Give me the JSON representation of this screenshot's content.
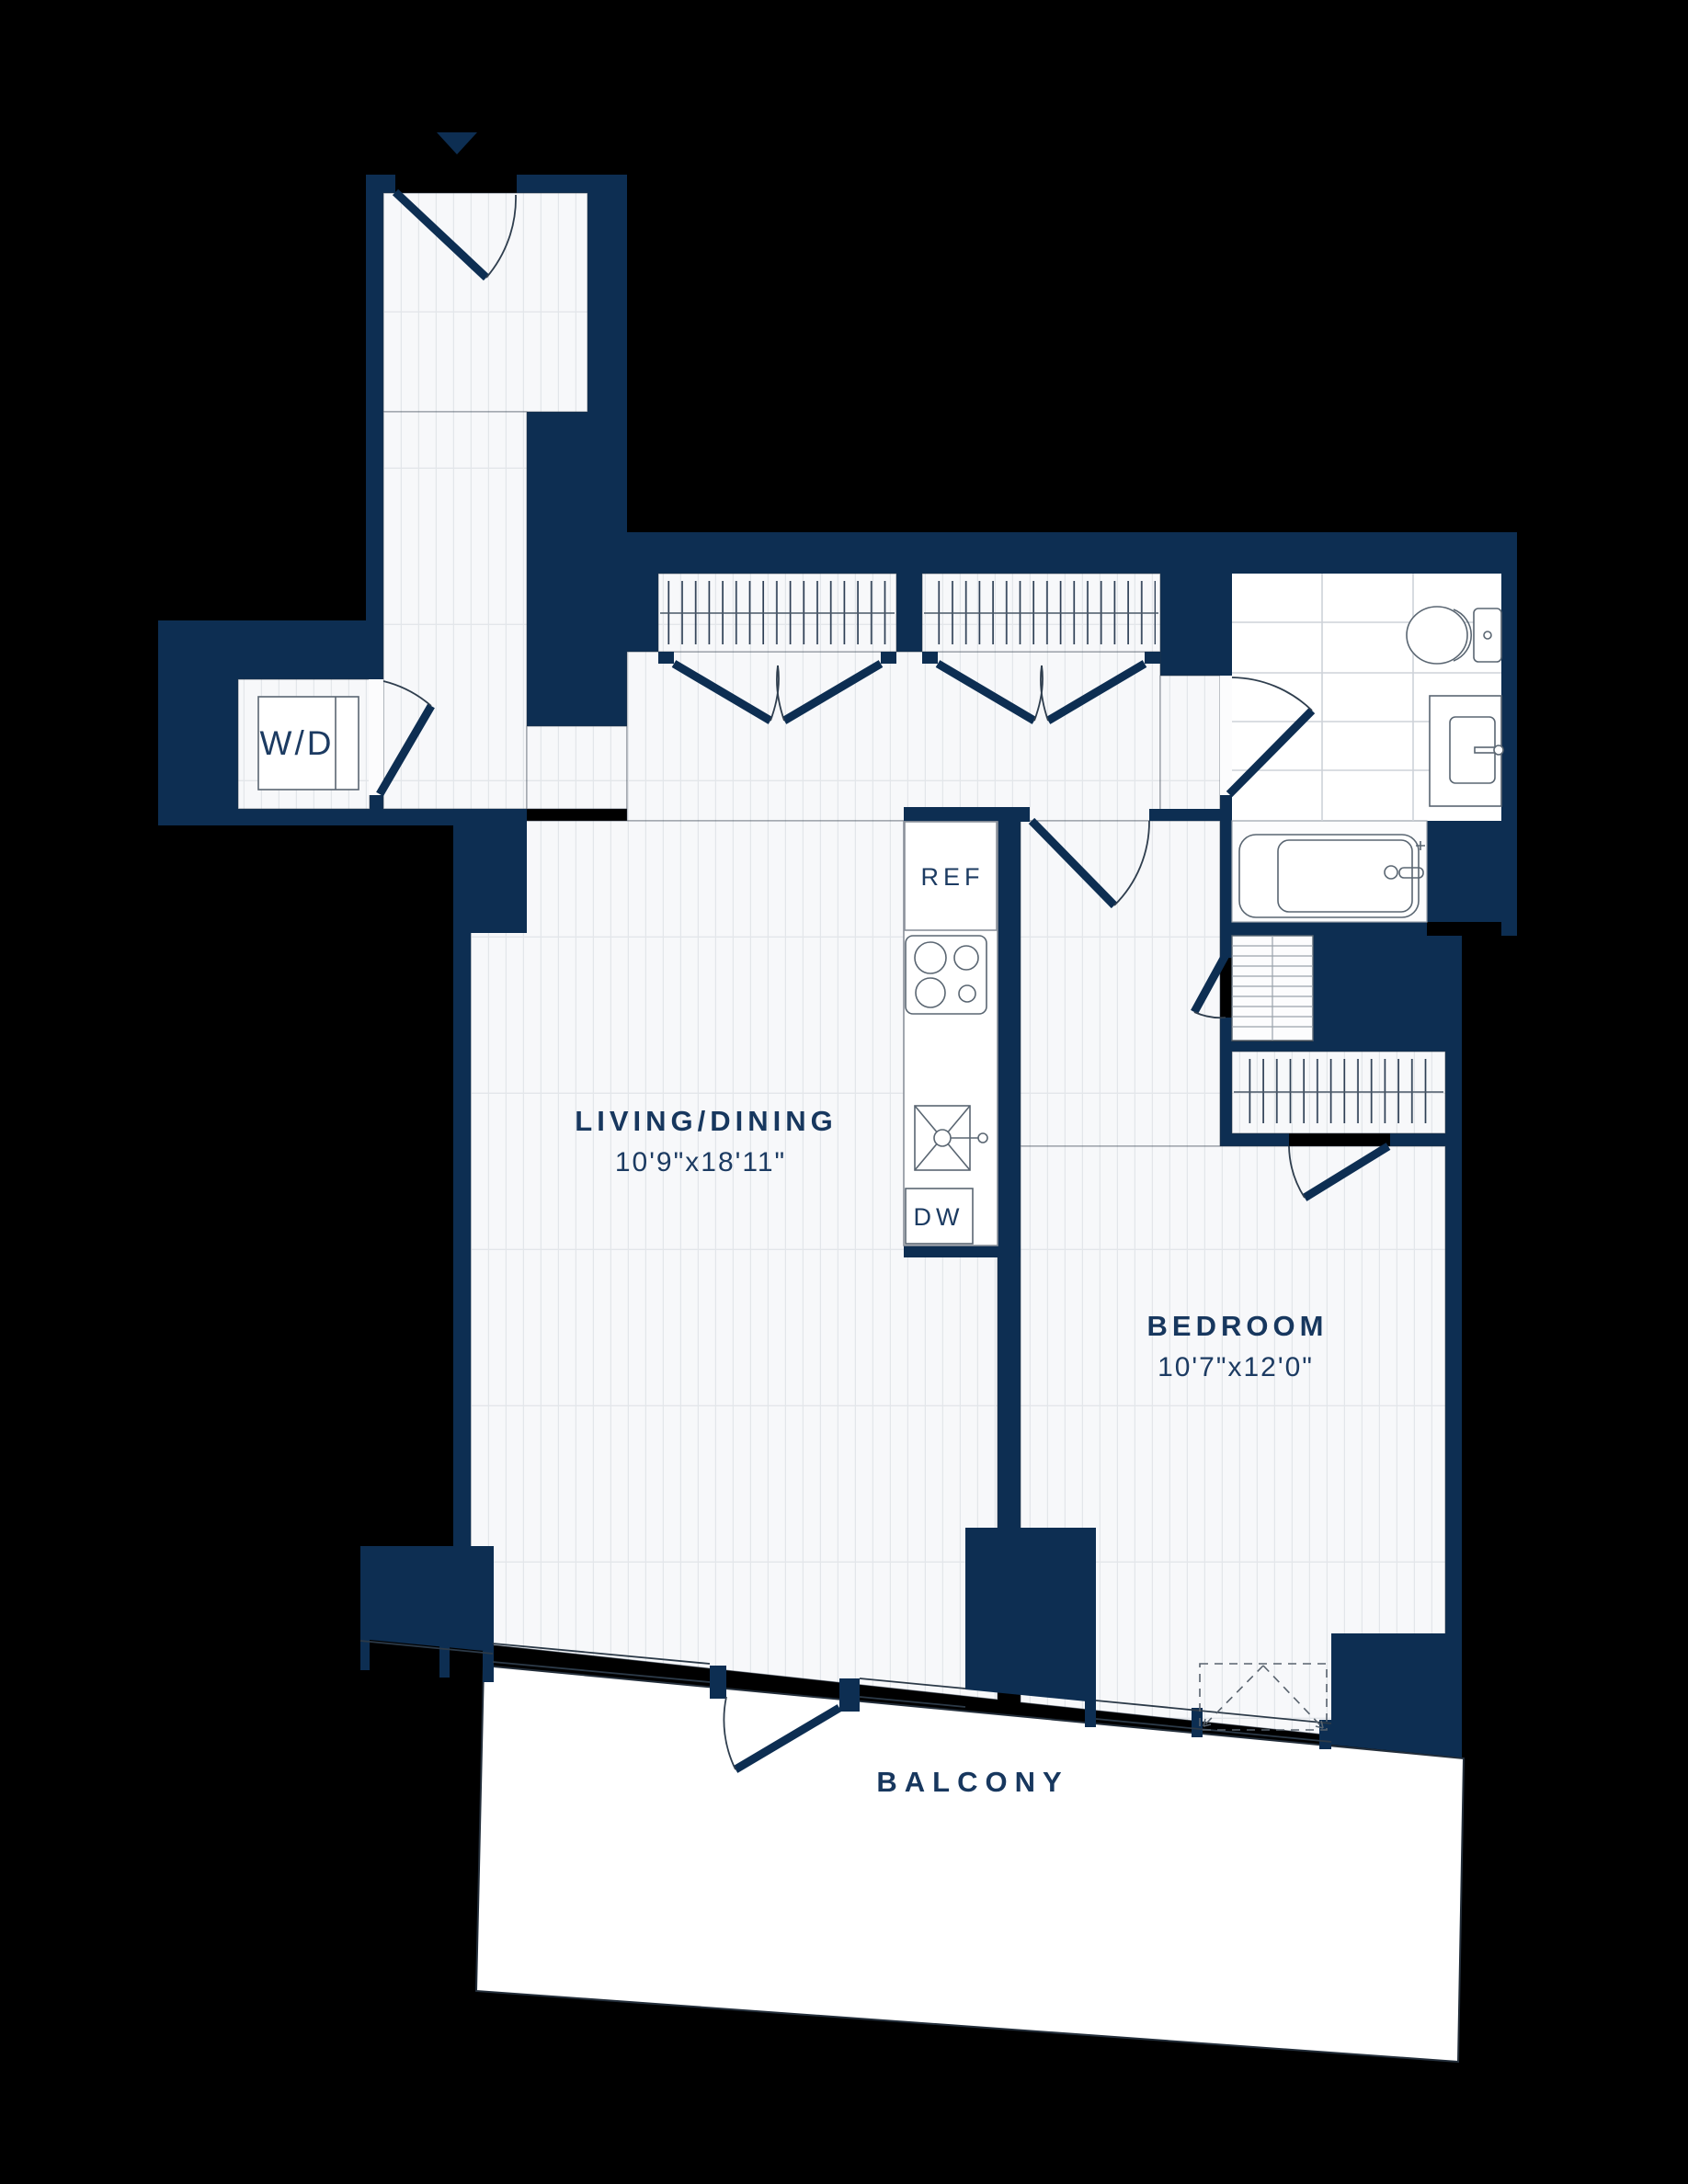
{
  "floorplan": {
    "labels": {
      "living_name": "LIVING/DINING",
      "living_dims": "10'9\"x18'11\"",
      "bedroom_name": "BEDROOM",
      "bedroom_dims": "10'7\"x12'0\"",
      "balcony_name": "BALCONY",
      "washer_dryer": "W/D",
      "refrigerator": "REF",
      "dishwasher": "DW"
    },
    "colors": {
      "wall": "#0d2e52",
      "label_text": "#17375e",
      "fixture_line": "#5a6672",
      "floor": "#f7f8fa",
      "background": "#000000"
    }
  }
}
